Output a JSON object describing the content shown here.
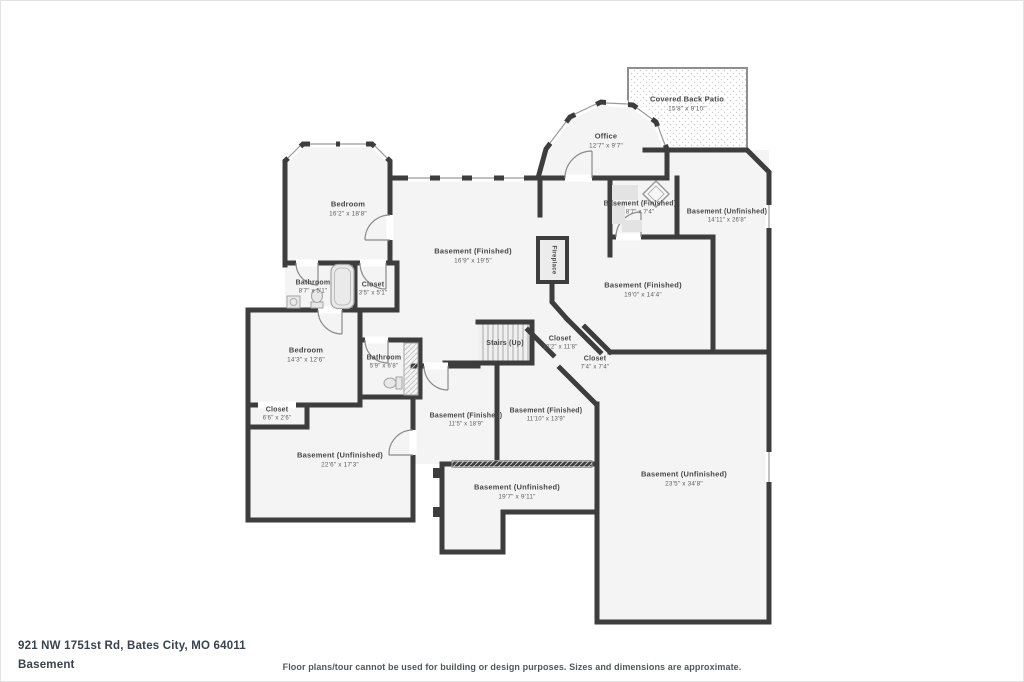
{
  "footer": {
    "address": "921 NW 1751st Rd, Bates City, MO 64011",
    "floor_label": "Basement",
    "disclaimer": "Floor plans/tour cannot be used for building or design purposes. Sizes and dimensions are approximate."
  },
  "colors": {
    "wall": "#3d3d3d",
    "floor_fill": "#f4f4f4",
    "label_text": "#474747",
    "footer_text": "#3a424d"
  },
  "rooms": [
    {
      "id": "covered-back-patio",
      "name": "Covered Back Patio",
      "dims": "15'8\" x 9'10\"",
      "x": 687,
      "y": 104,
      "size": "md"
    },
    {
      "id": "office",
      "name": "Office",
      "dims": "12'7\" x 9'7\"",
      "x": 606,
      "y": 141,
      "size": "md"
    },
    {
      "id": "bedroom-1",
      "name": "Bedroom",
      "dims": "16'2\" x 18'8\"",
      "x": 348,
      "y": 209,
      "size": "md"
    },
    {
      "id": "basement-finished-center",
      "name": "Basement (Finished)",
      "dims": "16'9\" x 19'5\"",
      "x": 473,
      "y": 256,
      "size": "md"
    },
    {
      "id": "fireplace",
      "name": "Fireplace",
      "dims": "",
      "x": 553,
      "y": 260,
      "size": "xs",
      "rotate": true
    },
    {
      "id": "basement-finished-ne",
      "name": "Basement (Finished)",
      "dims": "8'7\" x 7'4\"",
      "x": 640,
      "y": 208,
      "size": "sm"
    },
    {
      "id": "basement-unfinished-right",
      "name": "Basement (Unfinished)",
      "dims": "14'11\" x 26'8\"",
      "x": 727,
      "y": 216,
      "size": "sm"
    },
    {
      "id": "basement-finished-east",
      "name": "Basement (Finished)",
      "dims": "19'0\" x 14'4\"",
      "x": 643,
      "y": 290,
      "size": "md"
    },
    {
      "id": "bathroom-1",
      "name": "Bathroom",
      "dims": "8'7\" x 5'1\"",
      "x": 313,
      "y": 287,
      "size": "sm"
    },
    {
      "id": "closet-1",
      "name": "Closet",
      "dims": "3'5\" x 5'1\"",
      "x": 373,
      "y": 289,
      "size": "sm"
    },
    {
      "id": "bedroom-2",
      "name": "Bedroom",
      "dims": "14'3\" x 12'6\"",
      "x": 306,
      "y": 355,
      "size": "md"
    },
    {
      "id": "bathroom-2",
      "name": "Bathroom",
      "dims": "5'9\" x 6'8\"",
      "x": 384,
      "y": 362,
      "size": "sm"
    },
    {
      "id": "closet-2",
      "name": "Closet",
      "dims": "6'6\" x 2'6\"",
      "x": 277,
      "y": 414,
      "size": "sm"
    },
    {
      "id": "stairs-up",
      "name": "Stairs (Up)",
      "dims": "",
      "x": 505,
      "y": 344,
      "size": "sm"
    },
    {
      "id": "closet-3",
      "name": "Closet",
      "dims": "10'2\" x 11'8\"",
      "x": 560,
      "y": 343,
      "size": "sm"
    },
    {
      "id": "closet-4",
      "name": "Closet",
      "dims": "7'4\" x 7'4\"",
      "x": 595,
      "y": 363,
      "size": "sm"
    },
    {
      "id": "basement-finished-sw",
      "name": "Basement (Finished)",
      "dims": "11'5\" x 18'9\"",
      "x": 466,
      "y": 420,
      "size": "sm"
    },
    {
      "id": "basement-finished-s",
      "name": "Basement (Finished)",
      "dims": "11'10\" x 13'9\"",
      "x": 546,
      "y": 415,
      "size": "sm"
    },
    {
      "id": "basement-unfinished-left",
      "name": "Basement (Unfinished)",
      "dims": "22'6\" x 17'3\"",
      "x": 340,
      "y": 460,
      "size": "md"
    },
    {
      "id": "basement-unfinished-bottom",
      "name": "Basement (Unfinished)",
      "dims": "19'7\" x 9'11\"",
      "x": 517,
      "y": 492,
      "size": "md"
    },
    {
      "id": "basement-unfinished-big",
      "name": "Basement (Unfinished)",
      "dims": "23'5\" x 34'8\"",
      "x": 684,
      "y": 479,
      "size": "md"
    }
  ]
}
